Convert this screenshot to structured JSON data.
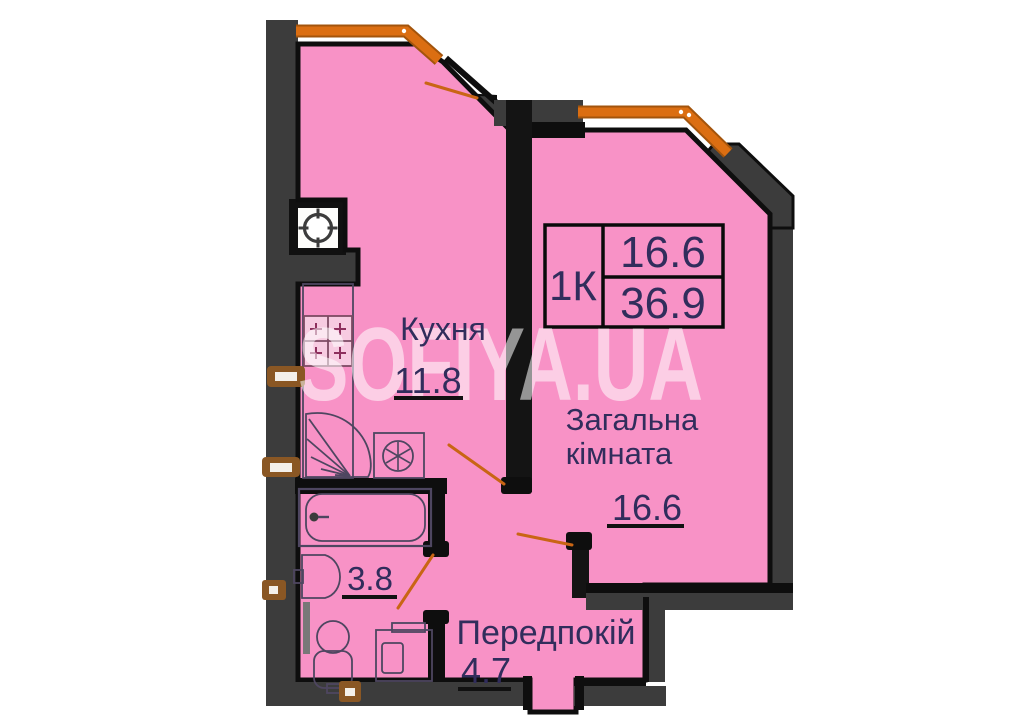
{
  "watermark": {
    "text": "SOFIYA.UA"
  },
  "legend": {
    "apartment_type": "1К",
    "living_area": "16.6",
    "total_area": "36.9"
  },
  "rooms": {
    "kitchen": {
      "name": "Кухня",
      "area": "11.8"
    },
    "living": {
      "name_line1": "Загальна",
      "name_line2": "кімната",
      "area": "16.6"
    },
    "hallway": {
      "name": "Передпокій",
      "area": "4.7"
    },
    "bathroom": {
      "area": "3.8"
    }
  },
  "colors": {
    "room_fill": "#F892C6",
    "wall_gray": "#3C3C3C",
    "outline_black": "#0E0E0E",
    "window_orange": "#DB6E12",
    "door_swing_orange": "#C96514",
    "label_text": "#312D5C",
    "valve_brown": "#8A5724"
  }
}
